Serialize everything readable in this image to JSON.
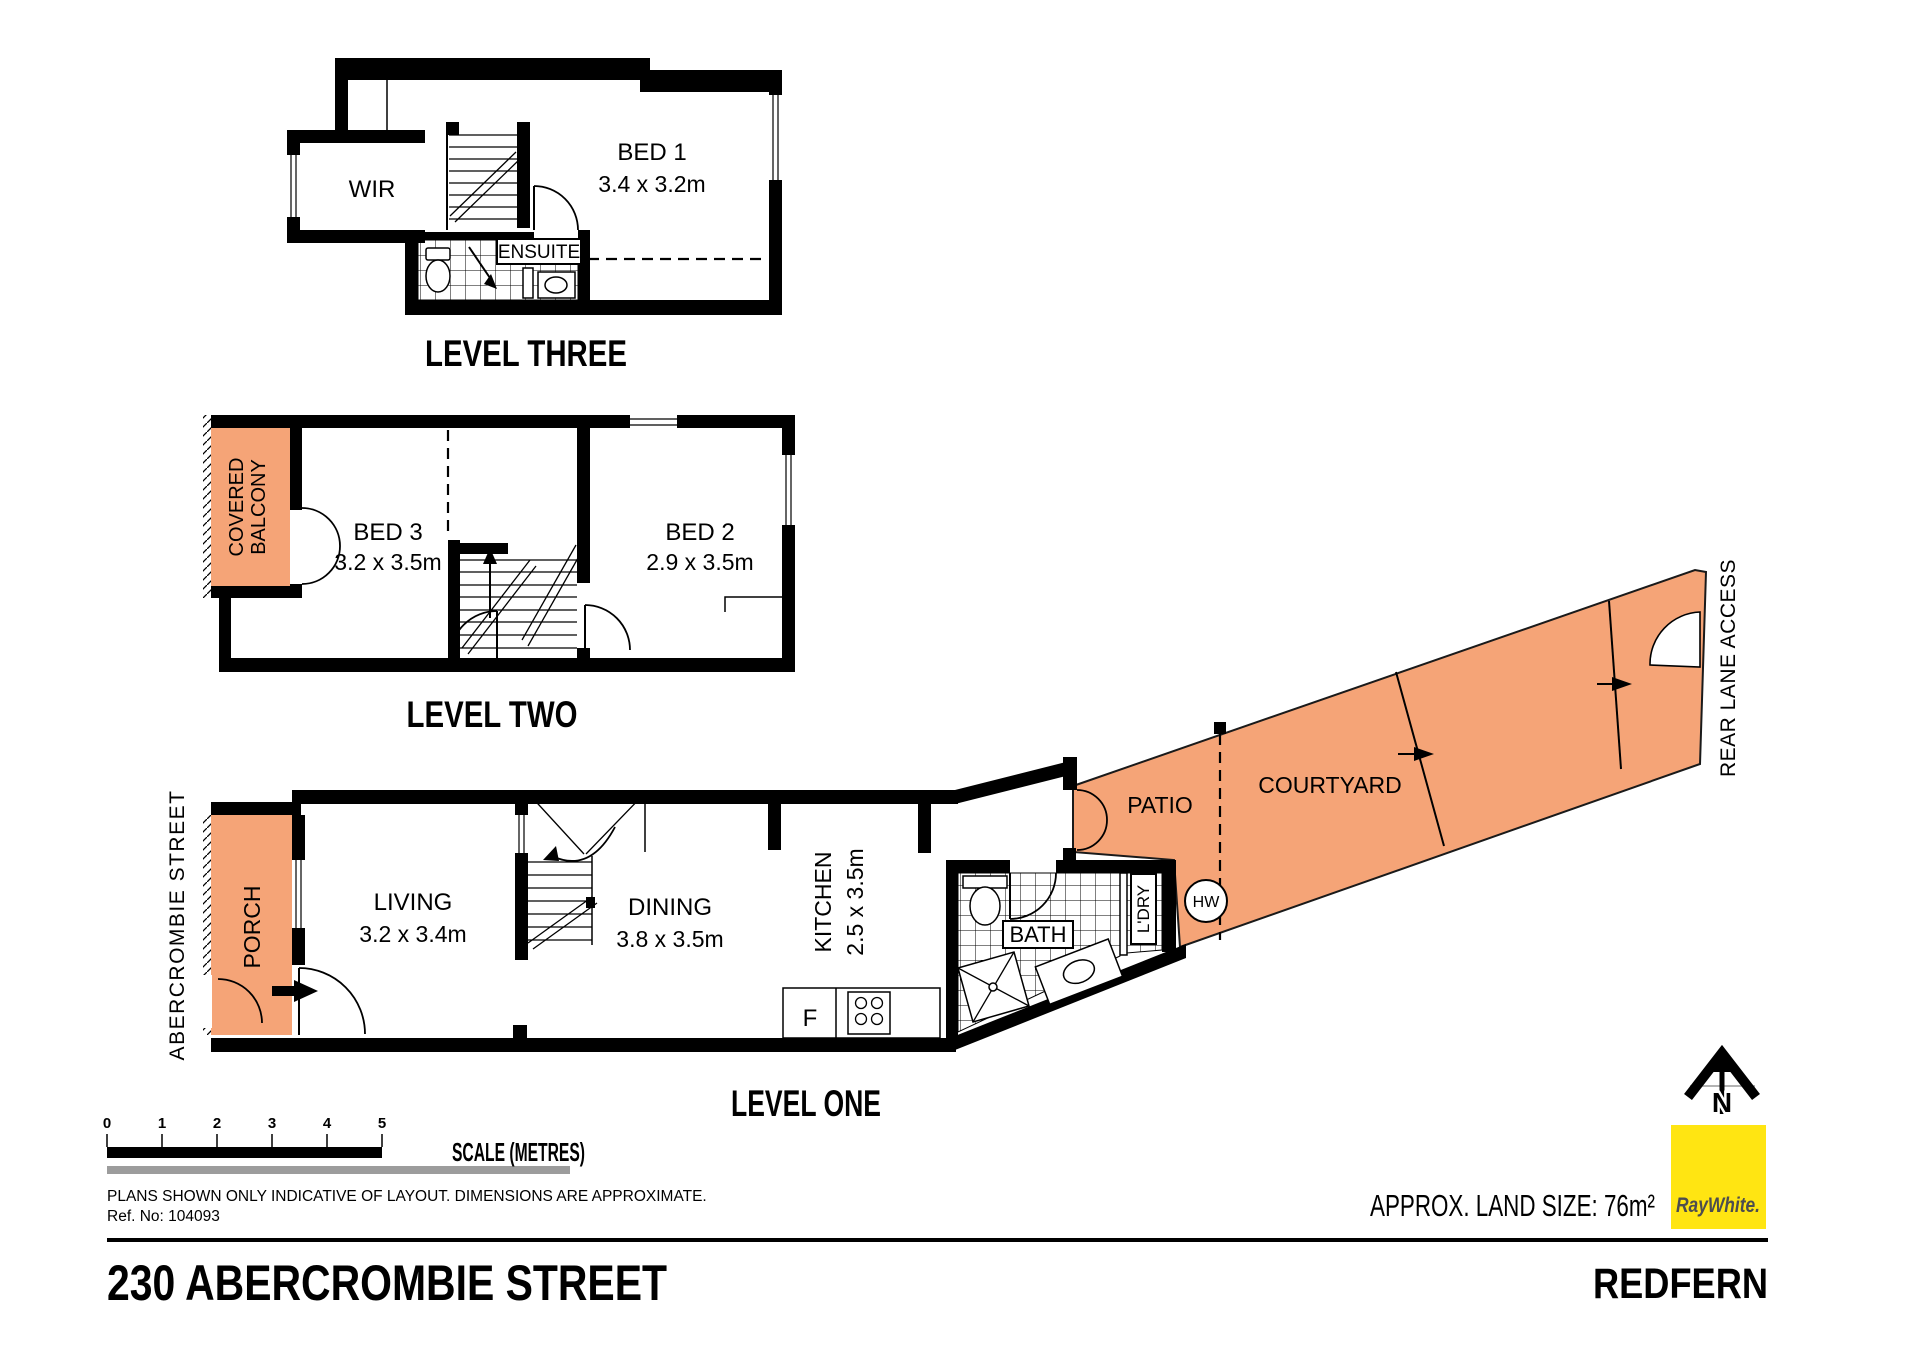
{
  "colors": {
    "outdoor": "#f5a477",
    "brand_yellow": "#ffe512",
    "brand_text": "#4d4d4f",
    "scale_gray": "#9c9c9c"
  },
  "level_three": {
    "title": "LEVEL THREE",
    "wir": "WIR",
    "bed1": "BED 1",
    "bed1_dims": "3.4 x 3.2m",
    "ensuite": "ENSUITE"
  },
  "level_two": {
    "title": "LEVEL TWO",
    "balcony_line1": "COVERED",
    "balcony_line2": "BALCONY",
    "bed3": "BED 3",
    "bed3_dims": "3.2 x 3.5m",
    "bed2": "BED 2",
    "bed2_dims": "2.9 x 3.5m"
  },
  "level_one": {
    "title": "LEVEL ONE",
    "street": "ABERCROMBIE STREET",
    "porch": "PORCH",
    "living": "LIVING",
    "living_dims": "3.2 x 3.4m",
    "dining": "DINING",
    "dining_dims": "3.8 x 3.5m",
    "kitchen": "KITCHEN",
    "kitchen_dims": "2.5 x 3.5m",
    "fridge": "F",
    "bath": "BATH",
    "laundry": "L'DRY",
    "hot_water": "HW",
    "patio": "PATIO",
    "courtyard": "COURTYARD",
    "rear_lane": "REAR LANE ACCESS"
  },
  "scale_bar": {
    "ticks": [
      "0",
      "1",
      "2",
      "3",
      "4",
      "5"
    ],
    "label": "SCALE (METRES)"
  },
  "disclaimer": "PLANS SHOWN ONLY INDICATIVE OF LAYOUT.  DIMENSIONS ARE APPROXIMATE.",
  "reference": "Ref. No: 104093",
  "footer": {
    "address": "230 ABERCROMBIE STREET",
    "suburb": "REDFERN",
    "land_size": "APPROX. LAND SIZE: 76m²"
  },
  "branding": {
    "agency": "RayWhite.",
    "north": "N"
  }
}
